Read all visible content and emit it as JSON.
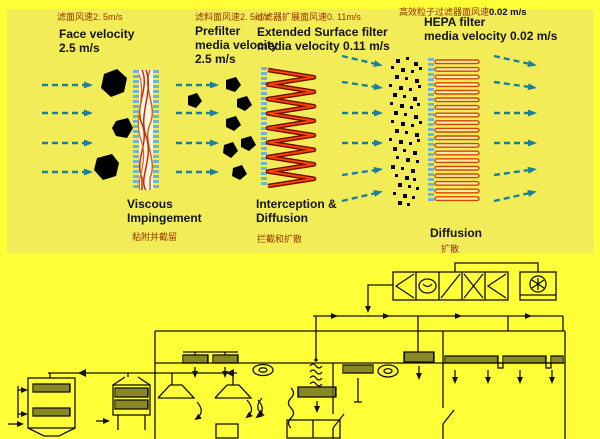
{
  "colors": {
    "page_bg": "#ffff38",
    "panel_bg": "#f1ec58",
    "arrow_teal": "#1a80a0",
    "chinese_text": "#993300",
    "filter_media_red": "#d43b00",
    "filter_frame_blue": "#6ab6d8",
    "particle_black": "#000000",
    "schematic_line": "#111111"
  },
  "stages": {
    "face": {
      "cn": "滤面风速2. 5m/s",
      "en1": "Face velocity",
      "en2": "2.5 m/s"
    },
    "prefilter": {
      "cn": "滤料面风速2. 5m/s",
      "en1": "Prefilter",
      "en2": "media velocity",
      "en3": "2.5 m/s",
      "mech_en1": "Viscous",
      "mech_en2": "Impingement",
      "mech_cn": "粘附并截留"
    },
    "extended": {
      "cn": "过滤器扩展面风速0. 11m/s",
      "en1": "Extended Surface filter",
      "en2": "media velocity 0.11 m/s",
      "mech_en1": "Interception &",
      "mech_en2": "Diffusion",
      "mech_cn": "拦截和扩散"
    },
    "hepa": {
      "cn_prefix": "高效粒子过滤器面风速",
      "cn_value": "0.02 m/s",
      "en1": "HEPA filter",
      "en2": "media velocity 0.02 m/s",
      "mech_en1": "Diffusion",
      "mech_cn": "扩散"
    }
  }
}
